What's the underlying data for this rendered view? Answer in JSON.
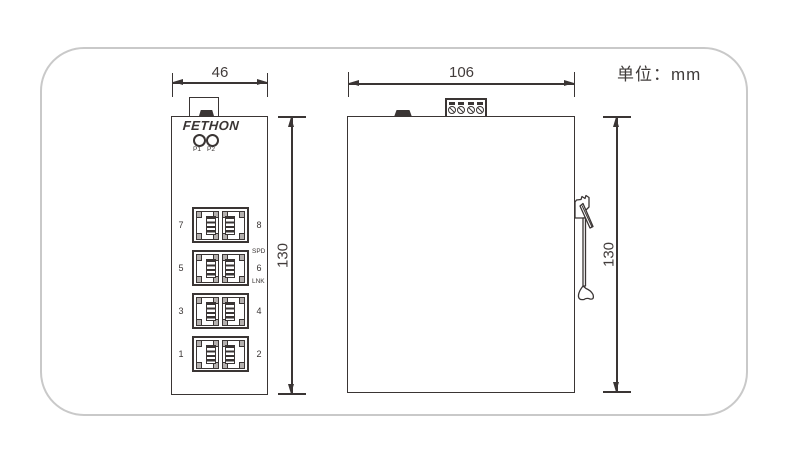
{
  "unit_label": "单位：mm",
  "colors": {
    "line": "#3a3534",
    "panel_border": "#c9c9c9",
    "background": "#ffffff"
  },
  "front_view": {
    "title": "front-view",
    "width_dim": "46",
    "height_dim": "130",
    "brand": "FETHON",
    "leds": [
      {
        "label": "P1"
      },
      {
        "label": "P2"
      }
    ],
    "port_rows": [
      {
        "left": "7",
        "right": "8"
      },
      {
        "left": "5",
        "right": "6"
      },
      {
        "left": "3",
        "right": "4"
      },
      {
        "left": "1",
        "right": "2"
      }
    ],
    "speed_label": "SPD",
    "link_label": "LNK"
  },
  "side_view": {
    "title": "side-view",
    "width_dim": "106",
    "height_dim": "130"
  }
}
